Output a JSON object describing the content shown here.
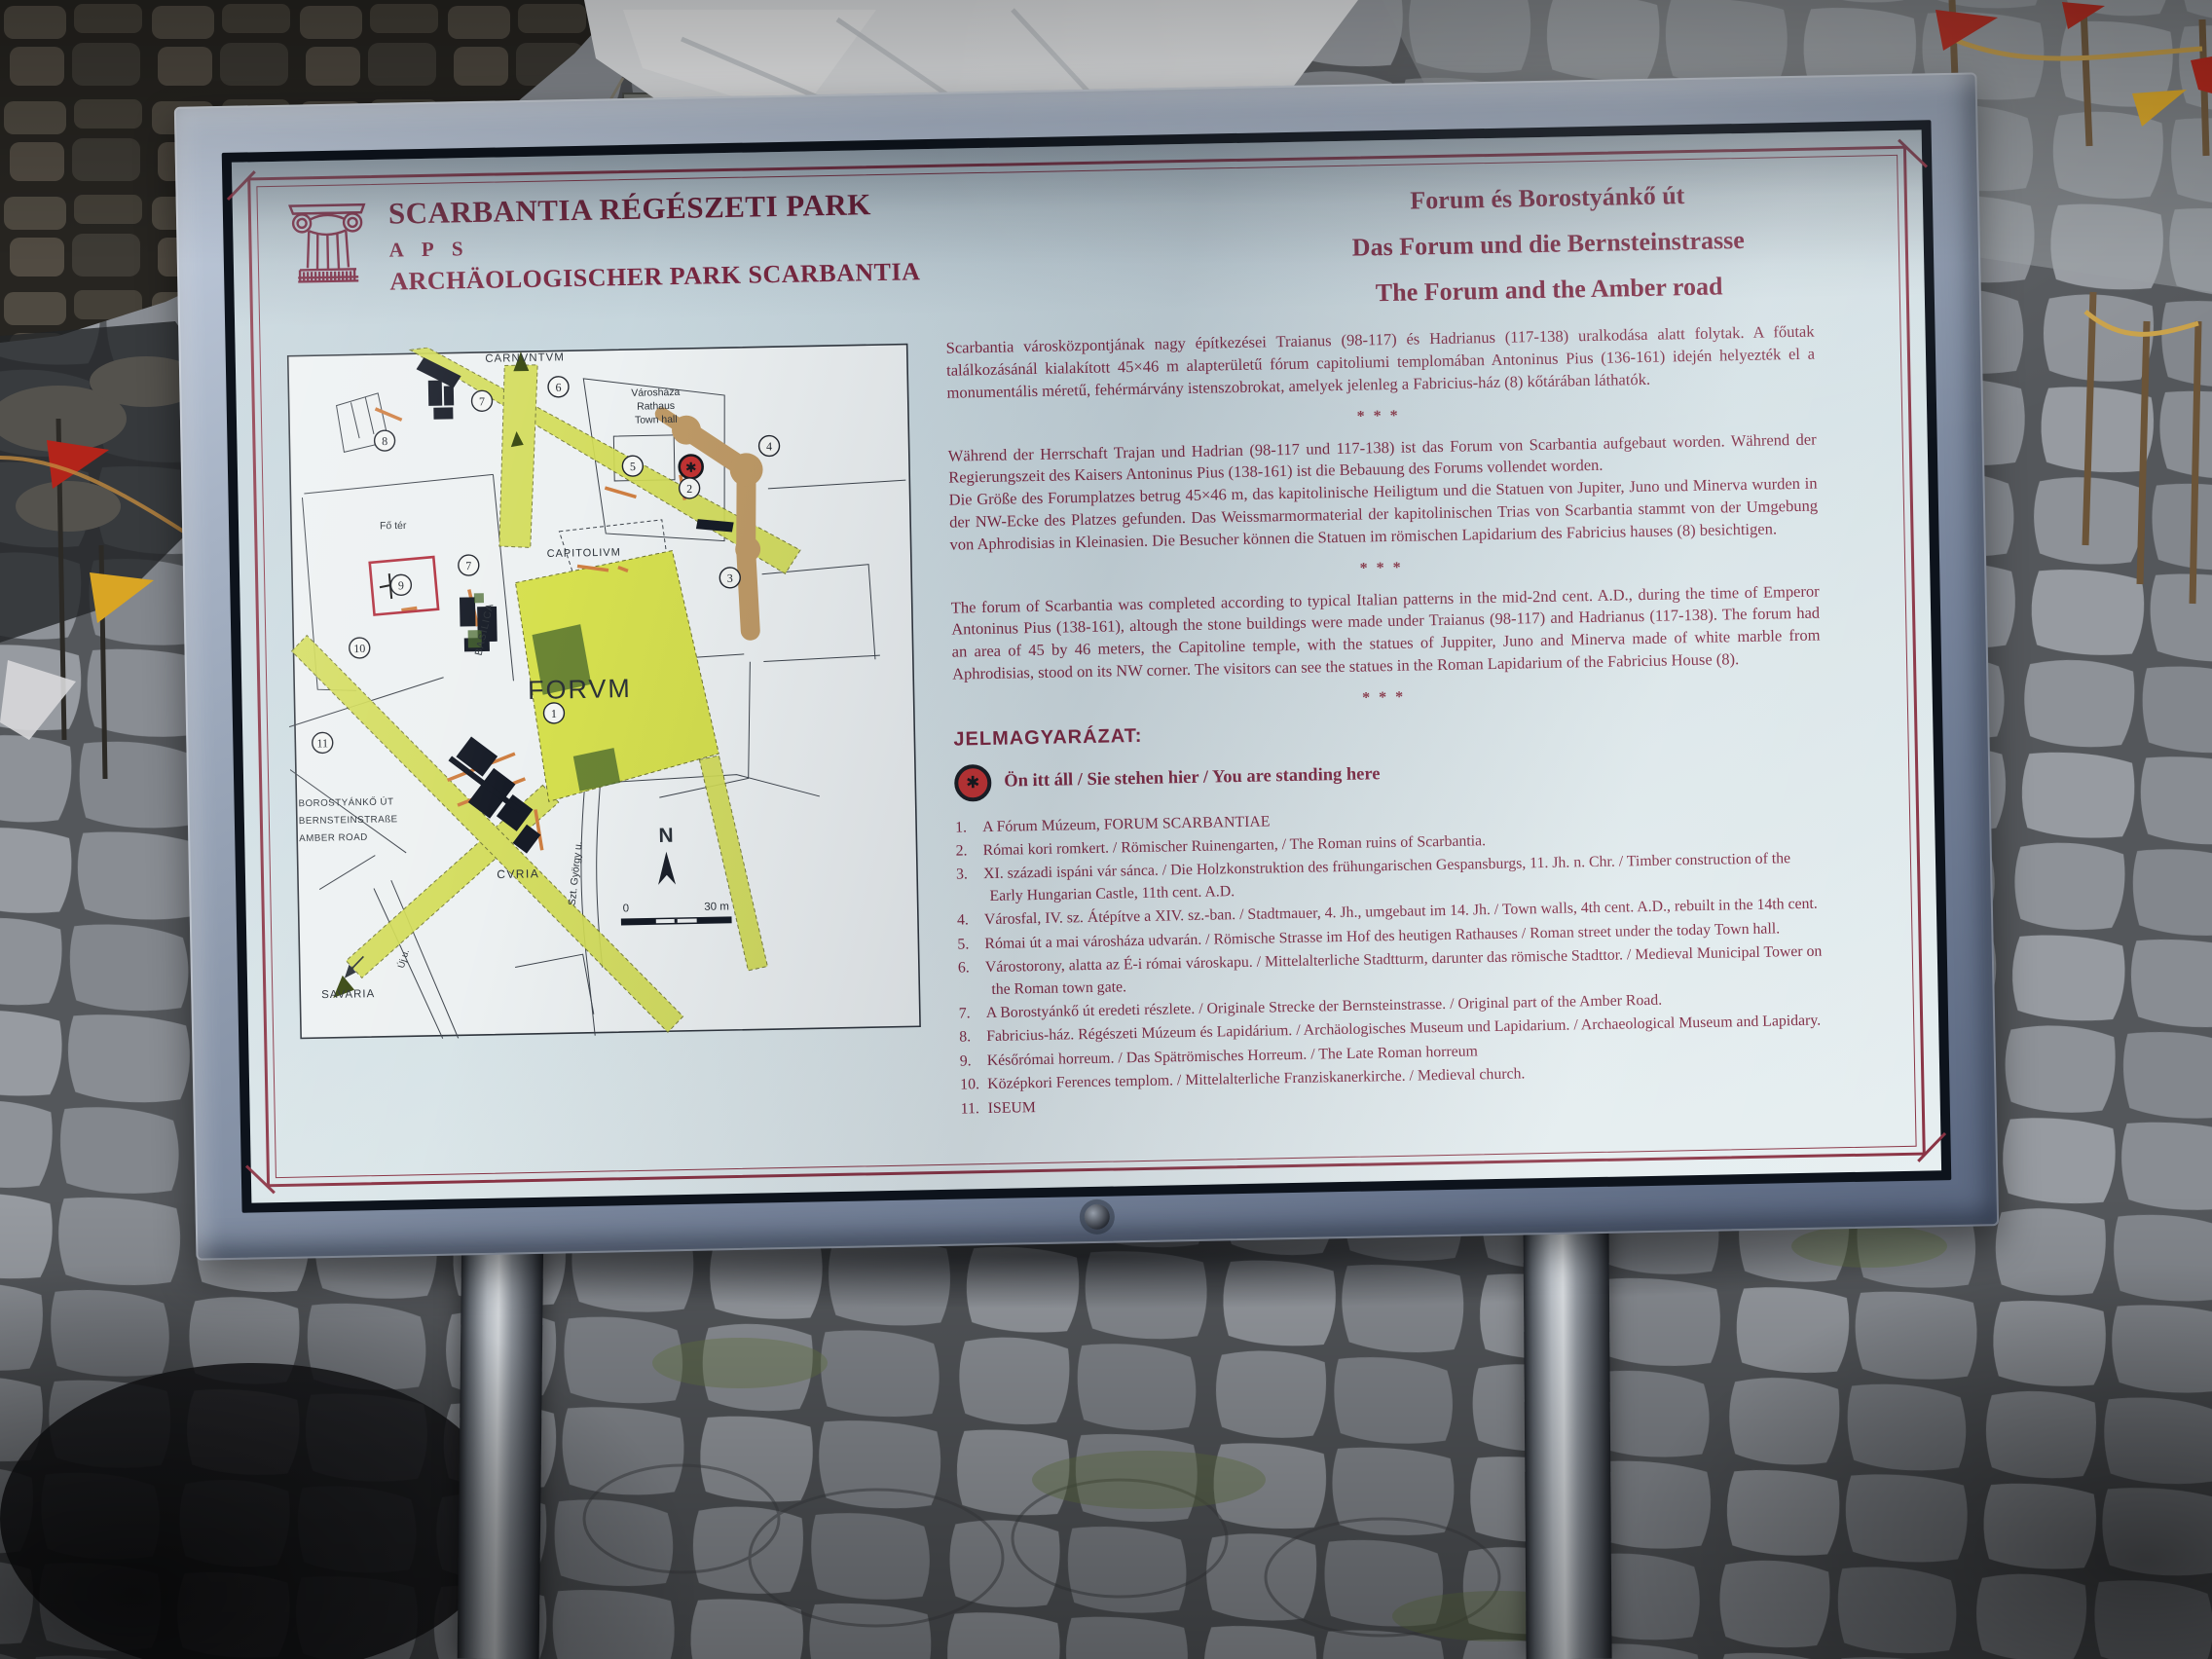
{
  "sign": {
    "header": {
      "logo_icon": "corinthian-capital",
      "title_hu": "SCARBANTIA RÉGÉSZETI PARK",
      "title_abbr": "A P S",
      "title_de": "ARCHÄOLOGISCHER PARK SCARBANTIA",
      "subtitle_hu": "Forum és Borostyánkő út",
      "subtitle_de": "Das Forum und die Bernsteinstrasse",
      "subtitle_en": "The Forum and the Amber road"
    },
    "intro": {
      "divider": "***",
      "hu": "Scarbantia városközpontjának nagy építkezései Traianus (98-117) és Hadrianus (117-138) uralkodása alatt folytak. A főutak találkozásánál kialakított 45×46 m alapterületű fórum capitoliumi templomában Antoninus Pius (136-161) idején helyezték el a monumentális méretű, fehérmárvány istenszobrokat, amelyek jelenleg a Fabricius-ház (8) kőtárában láthatók.",
      "de_1": "Während der Herrschaft Trajan und Hadrian (98-117 und 117-138) ist das Forum von Scarbantia aufgebaut worden. Während der Regierungszeit des Kaisers Antoninus Pius (138-161) ist die Bebauung des Forums vollendet worden.",
      "de_2": "Die Größe des Forumplatzes betrug 45×46 m, das kapitolinische Heiligtum und die Statuen von Jupiter, Juno und Minerva wurden in der NW-Ecke des Platzes gefunden. Das Weissmarmormaterial der kapitolinischen Trias von Scarbantia stammt von der Umgebung von Aphrodisias in Kleinasien. Die Besucher können die Statuen im römischen Lapidarium des Fabricius hauses (8) besichtigen.",
      "en": "The forum of Scarbantia was completed according to typical Italian patterns in the mid-2nd cent. A.D., during the time of Emperor Antoninus Pius (138-161), altough the stone buildings were made under Traianus (98-117) and Hadrianus (117-138). The forum had an area of 45 by 46 meters, the Capitoline temple, with the statues of Juppiter, Juno and Minerva made of white marble from Aphrodisias, stood on its NW corner. The visitors can see the statues in the Roman Lapidarium of the Fabricius House (8)."
    },
    "legend": {
      "heading": "JELMAGYARÁZAT:",
      "here_icon": "✱",
      "standing_here": "Ön itt áll / Sie stehen hier / You are standing here",
      "items": [
        {
          "num": "1.",
          "text": "A Fórum Múzeum, FORUM SCARBANTIAE"
        },
        {
          "num": "2.",
          "text": "Római kori romkert. / Römischer Ruinengarten, / The Roman ruins of Scarbantia."
        },
        {
          "num": "3.",
          "text": "XI. századi ispáni vár sánca. / Die Holzkonstruktion des frühungarischen Gespansburgs, 11. Jh. n. Chr. / Timber construction of the Early Hungarian Castle, 11th cent. A.D."
        },
        {
          "num": "4.",
          "text": "Városfal, IV. sz. Átépítve a XIV. sz.-ban. / Stadtmauer, 4. Jh., umgebaut im 14. Jh. / Town walls, 4th cent. A.D., rebuilt in the 14th cent."
        },
        {
          "num": "5.",
          "text": "Római út a mai városháza udvarán. / Römische Strasse im Hof des heutigen Rathauses / Roman street under the today Town hall."
        },
        {
          "num": "6.",
          "text": "Várostorony, alatta az É-i római városkapu. / Mittelalterliche Stadtturm, darunter das römische Stadttor. / Medieval Municipal Tower on the Roman town gate."
        },
        {
          "num": "7.",
          "text": "A Borostyánkő út eredeti részlete. / Originale Strecke der Bernsteinstrasse. / Original part of the Amber Road."
        },
        {
          "num": "8.",
          "text": "Fabricius-ház. Régészeti Múzeum és Lapidárium. / Archäologisches Museum und Lapidarium. / Archaeological Museum and Lapidary."
        },
        {
          "num": "9.",
          "text": "Későrómai horreum. / Das Spätrömisches Horreum. / The Late Roman horreum"
        },
        {
          "num": "10.",
          "text": "Középkori Ferences templom. / Mittelalterliche Franziskanerkirche. / Medieval church."
        },
        {
          "num": "11.",
          "text": "ISEUM"
        }
      ]
    },
    "map": {
      "labels": {
        "carnuntum": "CARNVNTVM",
        "town_hall_1": "Városháza",
        "town_hall_2": "Rathaus",
        "town_hall_3": "Town hall",
        "fo_ter": "Fő tér",
        "capitolium": "CAPITOLIVM",
        "basilica": "BASILICA",
        "forum": "FORVM",
        "curia": "CVRIA",
        "szt_gyorgy": "Szt. György u.",
        "uj_u": "Új u.",
        "savaria": "SAVARIA",
        "amber_1": "BOROSTYÁNKŐ ÚT",
        "amber_2": "BERNSTEINSTRAßE",
        "amber_3": "AMBER ROAD"
      },
      "north": "N",
      "scale": {
        "zero": "0",
        "label": "30 m"
      },
      "markers": [
        "1",
        "2",
        "3",
        "4",
        "5",
        "6",
        "7",
        "8",
        "9",
        "10",
        "11"
      ]
    },
    "colors": {
      "panel_text": "#7c2740",
      "ornament_border": "#8a3344",
      "road_green": "#d2dc55",
      "wall_brown": "#bf9a66",
      "you_are_here_red": "#c23232",
      "panel_background": "#d8e4e8"
    }
  }
}
